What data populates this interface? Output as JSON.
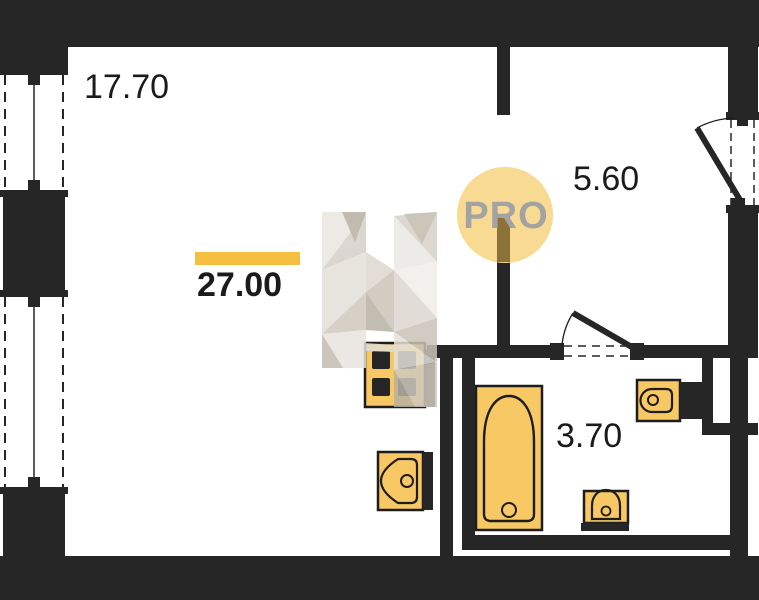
{
  "plan": {
    "type": "apartment-floor-plan",
    "rooms": [
      {
        "name": "living-room",
        "area": "17.70"
      },
      {
        "name": "total-apartment",
        "area": "27.00",
        "highlighted": true
      },
      {
        "name": "hallway",
        "area": "5.60"
      },
      {
        "name": "bathroom",
        "area": "3.70"
      }
    ],
    "fixtures": [
      "kitchen-stove",
      "kitchen-sink",
      "bathtub",
      "washbasin",
      "toilet"
    ],
    "openings": [
      "entry-door-right-wall",
      "bathroom-door",
      "hall-passage",
      "window-left-upper",
      "window-left-lower"
    ]
  },
  "watermark": {
    "text": "PRO",
    "letter": "H"
  },
  "colors": {
    "wall": "#262626",
    "fixture_fill": "#f8c865",
    "fixture_stroke": "#1d1d1d",
    "accent_underline": "#f6bf41",
    "watermark_circle": "#f8da92",
    "watermark_text": "#a3a3a3",
    "label_text": "#1b1b1b"
  }
}
